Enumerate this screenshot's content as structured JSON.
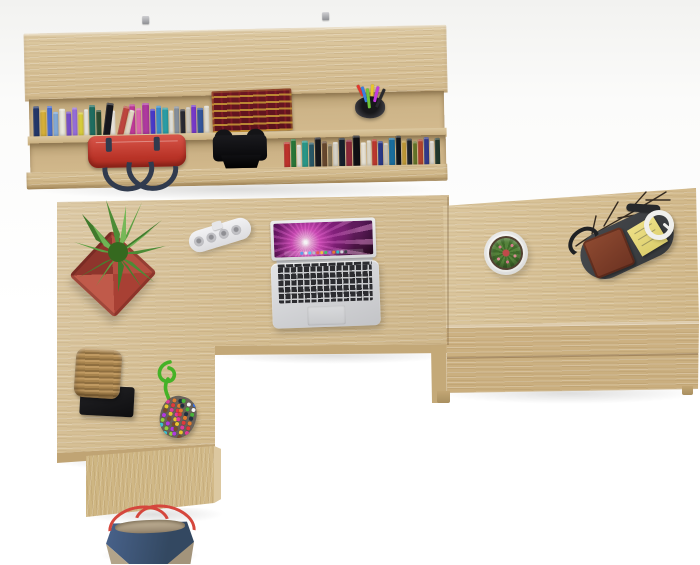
{
  "scene": {
    "name": "top-view home office desk set in oak",
    "items": [
      "wall shelf with books",
      "red handbag",
      "black case",
      "antique book",
      "pencil cup",
      "l-shaped desk",
      "potted plant",
      "power strip",
      "open laptop",
      "drawer unit",
      "cactus pot",
      "valet tray with wallet and notes",
      "earbuds",
      "decor branches",
      "wicker basket on stand",
      "beaded charm",
      "tote bag"
    ]
  },
  "colors": {
    "oak-top": "#d9c49b",
    "oak-front": "#cdb283",
    "oak-side": "#bfa477",
    "background": "#fbfbfa",
    "shadow": "rgba(0,0,0,0.13)",
    "bag-red": "#c23a31",
    "strap-navy": "#313b4e",
    "book-maroon": "#63141f",
    "book-gold": "#c49436",
    "pot-terracotta": "#b34f41",
    "plant-green": "#4c8c36",
    "laptop-silver": "#d6d7d9",
    "key-black": "#2c2c30",
    "screen-magenta": "#e855cd",
    "cactus-green": "#55823b",
    "cactus-pot-white": "#f3f3f0",
    "spine-pink": "#d87a8c",
    "tray-gray": "#3d4043",
    "wallet-brown": "#7b3a27",
    "notes-yellow": "#e7da7d",
    "basket-tan": "#b18c57",
    "stand-black": "#1c1c1e",
    "cord-green": "#45b227",
    "tote-blue": "#41597a",
    "tote-trim": "#b5a68c",
    "tote-handle": "#d5473d"
  },
  "shelf": {
    "upper_books": [
      {
        "color": "#24386b",
        "w": 6,
        "h": 33
      },
      {
        "color": "#d9b23a",
        "w": 6,
        "h": 29
      },
      {
        "color": "#4a6fd4",
        "w": 5,
        "h": 33
      },
      {
        "color": "#85aede",
        "w": 5,
        "h": 27
      },
      {
        "color": "#eceadf",
        "w": 6,
        "h": 30
      },
      {
        "color": "#7a50cf",
        "w": 5,
        "h": 27
      },
      {
        "color": "#9a70e0",
        "w": 5,
        "h": 31
      },
      {
        "color": "#ded33e",
        "w": 5,
        "h": 26
      },
      {
        "color": "#f2f0e8",
        "w": 4,
        "h": 29
      },
      {
        "color": "#1f6f62",
        "w": 6,
        "h": 33
      },
      {
        "color": "#2e4d31",
        "w": 5,
        "h": 28
      },
      {
        "color": "#17171d",
        "w": 7,
        "h": 35,
        "tilt": 8
      },
      {
        "color": "#efe9df",
        "w": 5,
        "h": 27
      },
      {
        "color": "#c2473f",
        "w": 6,
        "h": 32,
        "tilt": 14
      },
      {
        "color": "#e9dcc9",
        "w": 5,
        "h": 28,
        "tilt": 14
      },
      {
        "color": "#c23a9a",
        "w": 6,
        "h": 33
      },
      {
        "color": "#e466b4",
        "w": 5,
        "h": 29
      },
      {
        "color": "#b03aa0",
        "w": 7,
        "h": 34
      },
      {
        "color": "#4a3ad0",
        "w": 5,
        "h": 28
      },
      {
        "color": "#3a8fd0",
        "w": 5,
        "h": 31
      },
      {
        "color": "#2aa0a8",
        "w": 6,
        "h": 29
      },
      {
        "color": "#ebebe4",
        "w": 4,
        "h": 26
      },
      {
        "color": "#8a94a0",
        "w": 5,
        "h": 30
      },
      {
        "color": "#2a2a33",
        "w": 5,
        "h": 27
      },
      {
        "color": "#d8d2c8",
        "w": 4,
        "h": 29
      },
      {
        "color": "#7a3ad0",
        "w": 5,
        "h": 31
      },
      {
        "color": "#35589e",
        "w": 6,
        "h": 28
      },
      {
        "color": "#e8e4d8",
        "w": 5,
        "h": 30
      }
    ],
    "lower_books": [
      {
        "color": "#c0342c",
        "w": 6,
        "h": 28
      },
      {
        "color": "#2a7a3a",
        "w": 5,
        "h": 31
      },
      {
        "color": "#eae8e0",
        "w": 4,
        "h": 25
      },
      {
        "color": "#2a9a8a",
        "w": 6,
        "h": 29
      },
      {
        "color": "#2a5a6a",
        "w": 5,
        "h": 27
      },
      {
        "color": "#17171c",
        "w": 6,
        "h": 32
      },
      {
        "color": "#6a4a2f",
        "w": 5,
        "h": 28
      },
      {
        "color": "#8a7a5a",
        "w": 4,
        "h": 25
      },
      {
        "color": "#dcd8cc",
        "w": 5,
        "h": 27
      },
      {
        "color": "#17202c",
        "w": 6,
        "h": 31
      },
      {
        "color": "#8f2a3a",
        "w": 6,
        "h": 29
      },
      {
        "color": "#101014",
        "w": 7,
        "h": 33
      },
      {
        "color": "#efe9da",
        "w": 5,
        "h": 26
      },
      {
        "color": "#e8e2d2",
        "w": 4,
        "h": 28
      },
      {
        "color": "#c23a2f",
        "w": 5,
        "h": 29
      },
      {
        "color": "#2a3a8a",
        "w": 5,
        "h": 27
      },
      {
        "color": "#d0ccc0",
        "w": 4,
        "h": 25
      },
      {
        "color": "#1a6fa0",
        "w": 6,
        "h": 30
      },
      {
        "color": "#10141a",
        "w": 5,
        "h": 32
      },
      {
        "color": "#caa23a",
        "w": 4,
        "h": 27
      },
      {
        "color": "#20262c",
        "w": 5,
        "h": 29
      },
      {
        "color": "#6a7a2a",
        "w": 4,
        "h": 26
      },
      {
        "color": "#b8452f",
        "w": 5,
        "h": 28
      },
      {
        "color": "#343c8e",
        "w": 5,
        "h": 30
      },
      {
        "color": "#e5e2d8",
        "w": 4,
        "h": 26
      },
      {
        "color": "#223a2e",
        "w": 5,
        "h": 29
      }
    ],
    "pencil_cup": {
      "pens": [
        "#e0392f",
        "#3a7fe0",
        "#6fc43a",
        "#e6c52f",
        "#c23ae0",
        "#2a2a2e"
      ]
    }
  },
  "desk": {
    "laptop": {
      "dock": [
        "#5aa0e8",
        "#e8e8ea",
        "#58c8f0",
        "#b8bcc2",
        "#e85a50",
        "#f0c040",
        "#40c070",
        "#a060e0",
        "#e87a30",
        "#30c0c8",
        "#d0d4d8",
        "#384048"
      ]
    },
    "charm": {
      "beads": [
        "#e03a3a",
        "#3a6fe0",
        "#e8c52f",
        "#46b33a",
        "#b03ae0",
        "#e07a2f",
        "#3ac2d0",
        "#e03a9a",
        "#f2f2f2",
        "#7a4a2a",
        "#203040",
        "#8fd03a"
      ]
    }
  }
}
